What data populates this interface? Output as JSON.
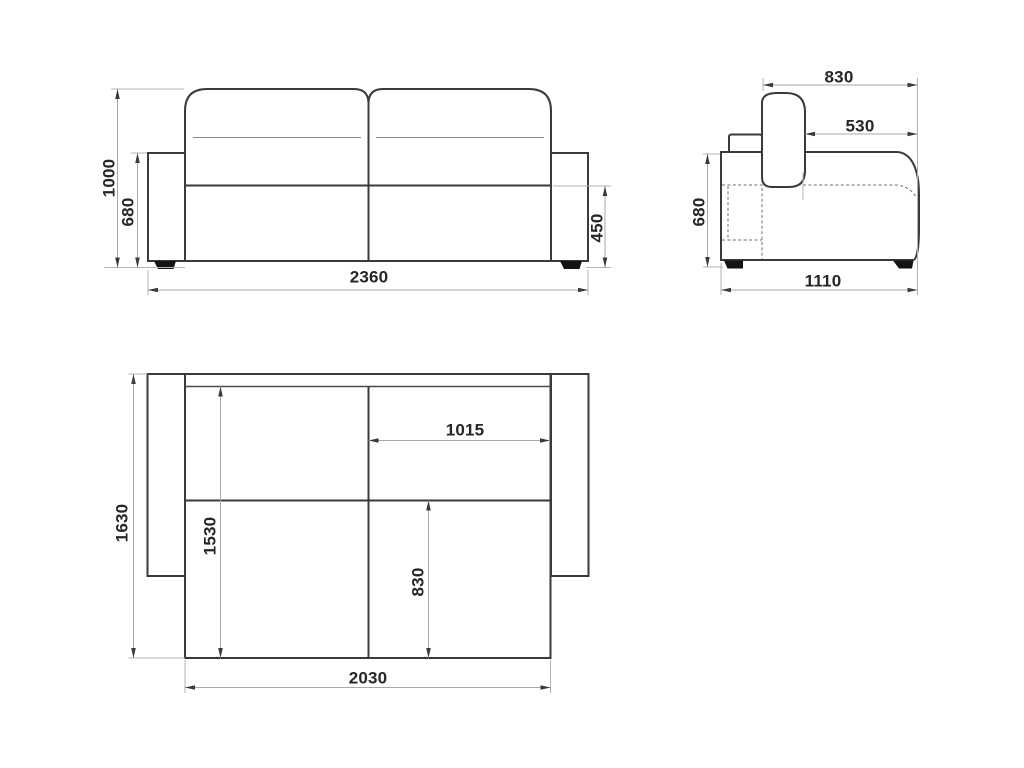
{
  "colors": {
    "background": "#ffffff",
    "outline": "#3a3a3a",
    "dimension_line": "#a9a9a9",
    "label_text": "#262626",
    "foot_fill": "#141414"
  },
  "views": {
    "front": {
      "dimensions": {
        "total_height": "1000",
        "armrest_height": "680",
        "seat_height": "450",
        "total_width": "2360"
      }
    },
    "side": {
      "dimensions": {
        "backrest_depth": "830",
        "seat_depth": "530",
        "armrest_height": "680",
        "total_depth": "1110"
      }
    },
    "top": {
      "dimensions": {
        "total_depth": "1630",
        "bed_length": "1530",
        "bed_half_width": "1015",
        "bed_section_depth": "830",
        "bed_width": "2030"
      }
    }
  }
}
